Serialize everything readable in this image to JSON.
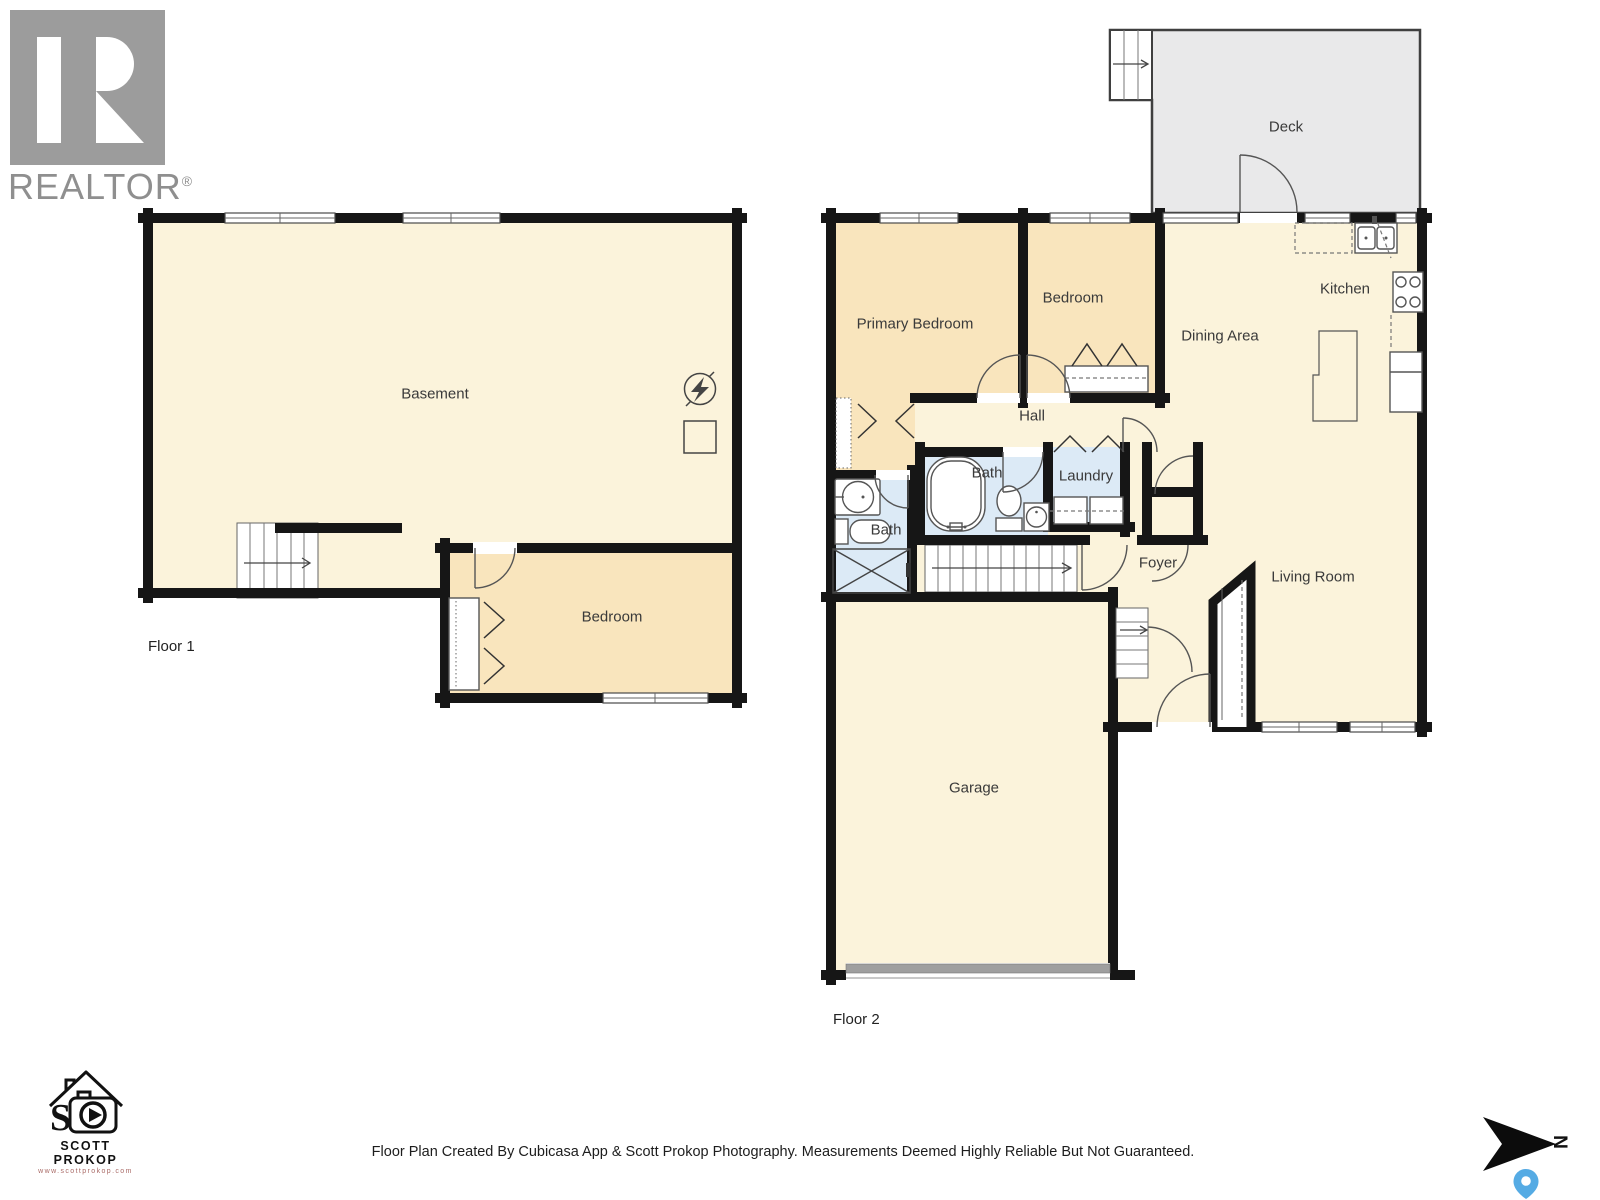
{
  "branding": {
    "realtor": {
      "text": "REALTOR",
      "reg": "®"
    },
    "photographer": {
      "name": "SCOTT PROKOP",
      "url": "www.scottprokop.com"
    }
  },
  "floors": {
    "floor1": {
      "label": "Floor 1",
      "rooms": [
        {
          "name": "Basement"
        },
        {
          "name": "Bedroom"
        }
      ]
    },
    "floor2": {
      "label": "Floor 2",
      "rooms": [
        {
          "name": "Deck"
        },
        {
          "name": "Primary Bedroom"
        },
        {
          "name": "Bedroom"
        },
        {
          "name": "Kitchen"
        },
        {
          "name": "Dining Area"
        },
        {
          "name": "Hall"
        },
        {
          "name": "Bath"
        },
        {
          "name": "Laundry"
        },
        {
          "name": "Bath"
        },
        {
          "name": "Foyer"
        },
        {
          "name": "Living Room"
        },
        {
          "name": "Garage"
        }
      ]
    }
  },
  "footer": {
    "disclaimer": "Floor Plan Created By Cubicasa App & Scott Prokop Photography. Measurements Deemed Highly Reliable But Not Guaranteed."
  },
  "compass": {
    "north_label": "N"
  },
  "colors": {
    "wall": "#161616",
    "room_cream": "#FBF3DB",
    "room_tan": "#F9E5BD",
    "bath_blue": "#DCEAF6",
    "deck_gray": "#E9E9EA",
    "pin_blue": "#55ABE4",
    "logo_gray": "#9C9C9C"
  }
}
